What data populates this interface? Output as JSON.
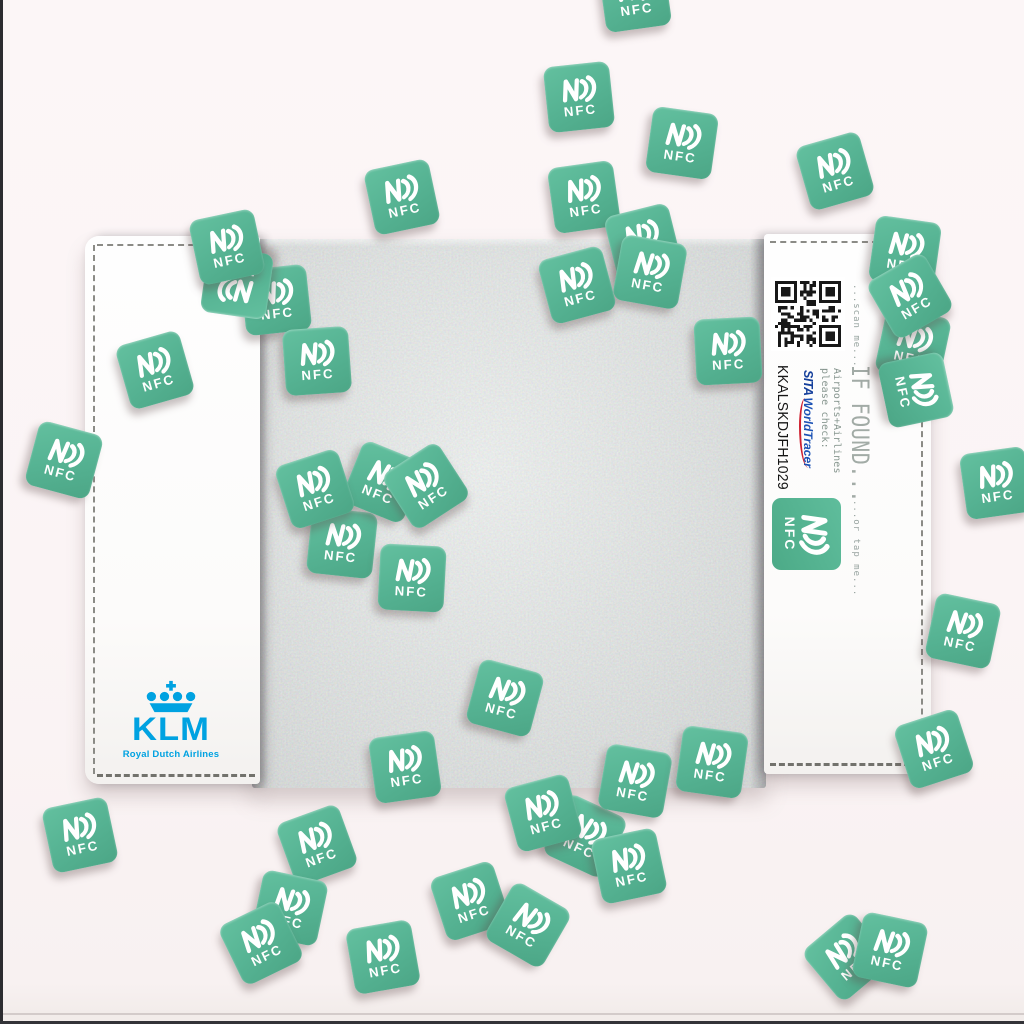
{
  "scene": {
    "description": "KLM branded travel-tag cover photographed on a pink surface, covered with scattered green NFC stickers",
    "background_color": "#fbf4f5",
    "frame_color": "#2c2c30",
    "concrete_color": "#c6c9c8"
  },
  "cover": {
    "left_panel": {
      "brand_name": "KLM",
      "brand_subtitle": "Royal Dutch Airlines",
      "brand_color": "#00a2e1"
    },
    "right_panel": {
      "scan_hint": "...scan me...",
      "found_title": "IF FOUND...",
      "check_line1": "Airports+Airlines",
      "check_line2": "please check:",
      "sita_brand": "SITA",
      "worldtracer_brand": "WorldTracer",
      "sita_color": "#143f9b",
      "worldtracer_accent": "#cf2030",
      "tag_code": "KKALSKDJFH1029",
      "tap_hint": "...or tap me...",
      "printed_nfc_label": "NFC"
    }
  },
  "stickers": {
    "label": "NFC",
    "color": "#55b292",
    "count": 44,
    "positions": [
      {
        "x": 635,
        "y": -4,
        "r": -8
      },
      {
        "x": 579,
        "y": 97,
        "r": -6
      },
      {
        "x": 682,
        "y": 143,
        "r": 8
      },
      {
        "x": 584,
        "y": 197,
        "r": -8
      },
      {
        "x": 402,
        "y": 197,
        "r": -12
      },
      {
        "x": 835,
        "y": 171,
        "r": -16
      },
      {
        "x": 276,
        "y": 300,
        "r": -6
      },
      {
        "x": 237,
        "y": 283,
        "r": 188
      },
      {
        "x": 227,
        "y": 247,
        "r": -12
      },
      {
        "x": 317,
        "y": 361,
        "r": -4
      },
      {
        "x": 155,
        "y": 370,
        "r": -16
      },
      {
        "x": 64,
        "y": 460,
        "r": 15
      },
      {
        "x": 643,
        "y": 242,
        "r": -14
      },
      {
        "x": 650,
        "y": 272,
        "r": 10
      },
      {
        "x": 577,
        "y": 285,
        "r": -15
      },
      {
        "x": 728,
        "y": 351,
        "r": -3
      },
      {
        "x": 905,
        "y": 252,
        "r": 8
      },
      {
        "x": 913,
        "y": 345,
        "r": 12
      },
      {
        "x": 916,
        "y": 390,
        "r": 78
      },
      {
        "x": 910,
        "y": 296,
        "r": -30
      },
      {
        "x": 996,
        "y": 483,
        "r": -8
      },
      {
        "x": 342,
        "y": 543,
        "r": 6
      },
      {
        "x": 383,
        "y": 482,
        "r": 22
      },
      {
        "x": 426,
        "y": 486,
        "r": -33
      },
      {
        "x": 315,
        "y": 489,
        "r": -18
      },
      {
        "x": 412,
        "y": 578,
        "r": 3
      },
      {
        "x": 505,
        "y": 698,
        "r": 15
      },
      {
        "x": 963,
        "y": 631,
        "r": 12
      },
      {
        "x": 405,
        "y": 767,
        "r": -8
      },
      {
        "x": 80,
        "y": 835,
        "r": -12
      },
      {
        "x": 317,
        "y": 845,
        "r": -20
      },
      {
        "x": 290,
        "y": 908,
        "r": 12
      },
      {
        "x": 261,
        "y": 943,
        "r": -26
      },
      {
        "x": 383,
        "y": 957,
        "r": -10
      },
      {
        "x": 585,
        "y": 836,
        "r": 25
      },
      {
        "x": 543,
        "y": 813,
        "r": -15
      },
      {
        "x": 635,
        "y": 781,
        "r": 10
      },
      {
        "x": 629,
        "y": 866,
        "r": -12
      },
      {
        "x": 470,
        "y": 901,
        "r": -18
      },
      {
        "x": 528,
        "y": 925,
        "r": 30
      },
      {
        "x": 712,
        "y": 762,
        "r": 8
      },
      {
        "x": 934,
        "y": 749,
        "r": -18
      },
      {
        "x": 847,
        "y": 957,
        "r": -40
      },
      {
        "x": 890,
        "y": 950,
        "r": 12
      }
    ]
  }
}
